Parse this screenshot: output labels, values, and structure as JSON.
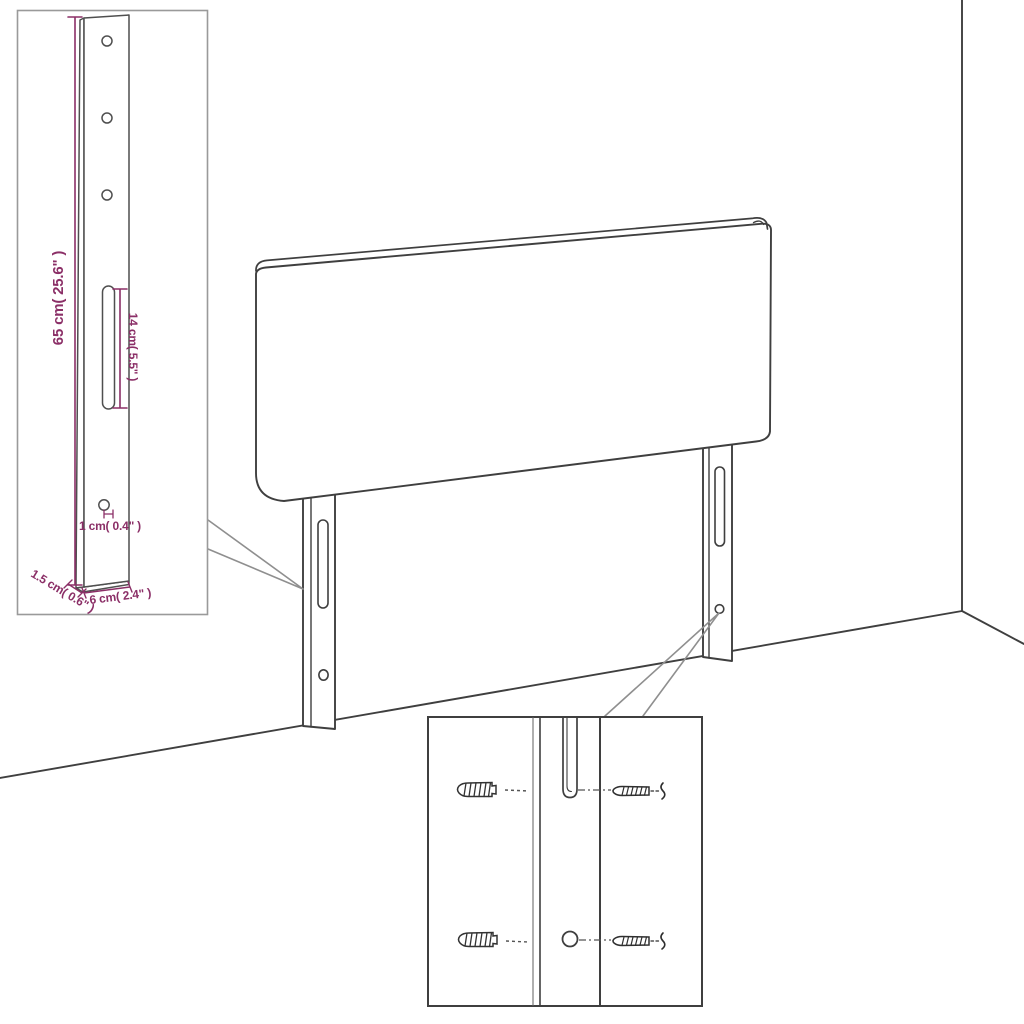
{
  "diagram": {
    "title": "Headboard with legs — product dimension diagram",
    "background": "#ffffff",
    "line_color": "#3f3f3f",
    "callout_color": "#8f8f8f",
    "dimension_color": "#8b2f67",
    "inset_border_color": "#9a9a9a"
  },
  "inset_leg_detail": {
    "dimensions": {
      "height": "65 cm( 25.6\" )",
      "slot_length": "14 cm( 5.5\" )",
      "hole_diameter": "1 cm( 0.4\" )",
      "thickness": "1.5 cm( 0.6\" )",
      "width": "6 cm( 2.4\" )"
    }
  },
  "inset_mounting_detail": {
    "parts": [
      "wall-anchor",
      "leg-rail-slot",
      "leg-rail-hole",
      "screw"
    ]
  },
  "scene": {
    "parts": [
      "headboard-panel",
      "left-leg",
      "right-leg",
      "wall-corner",
      "floor-edges"
    ]
  }
}
